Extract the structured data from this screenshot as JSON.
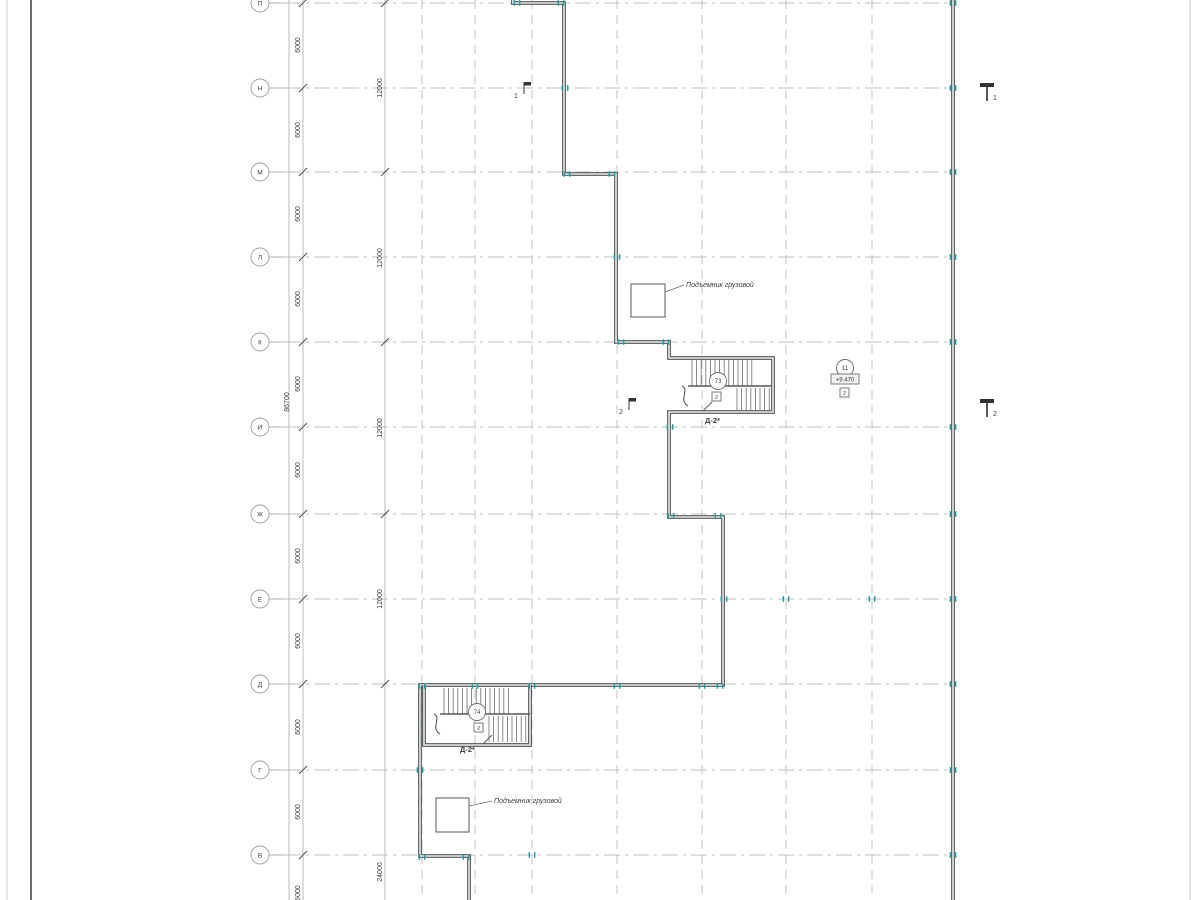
{
  "drawing": {
    "type": "architectural-floor-plan",
    "rows": [
      {
        "label": "П",
        "y": 3
      },
      {
        "label": "Н",
        "y": 88
      },
      {
        "label": "М",
        "y": 172
      },
      {
        "label": "Л",
        "y": 257
      },
      {
        "label": "К",
        "y": 342
      },
      {
        "label": "И",
        "y": 427
      },
      {
        "label": "Ж",
        "y": 514
      },
      {
        "label": "Е",
        "y": 599
      },
      {
        "label": "Д",
        "y": 684
      },
      {
        "label": "Г",
        "y": 770
      },
      {
        "label": "В",
        "y": 855
      }
    ],
    "cols_x": [
      422,
      475,
      532,
      617,
      702,
      786,
      872
    ],
    "right_wall_x": 953,
    "dims": {
      "overall": {
        "value": "86700",
        "x": 289,
        "text_y": 402
      },
      "d6000": {
        "value": "6000",
        "line_x": 303,
        "text_x": 300,
        "ys": [
          45,
          130,
          214,
          299,
          384,
          470,
          556,
          641,
          727,
          812,
          893
        ]
      },
      "d12000": {
        "line_x": 385,
        "text_x": 382,
        "tick_rows": [
          "П",
          "М",
          "К",
          "Ж",
          "Д"
        ],
        "labels": [
          {
            "value": "12000",
            "y": 88
          },
          {
            "value": "12000",
            "y": 258
          },
          {
            "value": "12000",
            "y": 428
          },
          {
            "value": "12000",
            "y": 599
          },
          {
            "value": "24000",
            "y": 872
          }
        ]
      }
    },
    "walls": {
      "outline": "M513,0 L513,3 L564,3 L564,174 L616,174 L616,342 L669,342 L669,358 L773,358 L773,412 L669,412 L669,517 L723,517 L723,685 L420,685 L420,856 L469,856 L469,900",
      "right": "M953,0 L953,900",
      "stair2_box": "M424,685 L424,745 L530,745 L530,685"
    },
    "stairs": [
      {
        "name": "stair-1",
        "circle": "73",
        "square": "2",
        "door_label": "Д-2*",
        "box": [
          669,
          358,
          104,
          54
        ],
        "flight1": [
          692,
          360,
          64,
          26
        ],
        "flight2": [
          737,
          388,
          35,
          22
        ],
        "divider_y": 386,
        "circle_cx": 718,
        "circle_cy": 381,
        "square_x": 712,
        "square_y": 392,
        "label_x": 705,
        "label_y": 423,
        "door_line": [
          703,
          411,
          712,
          402
        ]
      },
      {
        "name": "stair-2",
        "circle": "74",
        "square": "2",
        "door_label": "Д-2*",
        "box": [
          424,
          686,
          106,
          59
        ],
        "flight1": [
          444,
          688,
          66,
          26
        ],
        "flight2": [
          489,
          716,
          41,
          26
        ],
        "divider_y": 714,
        "circle_cx": 477,
        "circle_cy": 712,
        "square_x": 474,
        "square_y": 723,
        "label_x": 460,
        "label_y": 752,
        "door_line": [
          483,
          744,
          492,
          735
        ]
      }
    ],
    "lifts": [
      {
        "label": "Подъемник грузовой",
        "rect": [
          631,
          284,
          34,
          33
        ],
        "leader": [
          665,
          292,
          684,
          285
        ],
        "lx": 686,
        "ly": 287
      },
      {
        "label": "Подъемник грузовой",
        "rect": [
          436,
          798,
          33,
          34
        ],
        "leader": [
          469,
          806,
          492,
          801
        ],
        "lx": 494,
        "ly": 803
      }
    ],
    "section_marks": [
      {
        "n": "1",
        "x": 524,
        "y": 88,
        "side": "left"
      },
      {
        "n": "1",
        "x": 987,
        "y": 88,
        "side": "right"
      },
      {
        "n": "2",
        "x": 629,
        "y": 404,
        "side": "left"
      },
      {
        "n": "2",
        "x": 987,
        "y": 404,
        "side": "right"
      }
    ],
    "level_mark": {
      "circle": "11",
      "level": "+9.470",
      "square": "2",
      "cx": 845,
      "cy": 368,
      "box": [
        831,
        374,
        28,
        10
      ],
      "sq": [
        840,
        388,
        9,
        9
      ]
    },
    "ticks": [
      [
        953,
        3
      ],
      [
        953,
        88
      ],
      [
        953,
        172
      ],
      [
        953,
        257
      ],
      [
        953,
        342
      ],
      [
        953,
        427
      ],
      [
        953,
        514
      ],
      [
        953,
        599
      ],
      [
        953,
        684
      ],
      [
        953,
        770
      ],
      [
        953,
        855
      ],
      [
        517,
        3
      ],
      [
        561,
        3
      ],
      [
        565,
        88
      ],
      [
        567,
        174
      ],
      [
        612,
        174
      ],
      [
        617,
        257
      ],
      [
        621,
        342
      ],
      [
        666,
        342
      ],
      [
        670,
        427
      ],
      [
        671,
        516
      ],
      [
        718,
        516
      ],
      [
        724,
        599
      ],
      [
        786,
        599
      ],
      [
        872,
        599
      ],
      [
        422,
        686
      ],
      [
        475,
        686
      ],
      [
        532,
        686
      ],
      [
        617,
        686
      ],
      [
        702,
        686
      ],
      [
        720,
        686
      ],
      [
        420,
        770
      ],
      [
        422,
        857
      ],
      [
        466,
        857
      ],
      [
        532,
        855
      ]
    ],
    "colors": {
      "wall": "#54585a",
      "wall_inner": "#ebebeb",
      "grid": "#b9c0c0",
      "tick": "#2a9a9e",
      "text": "#3a3d3e",
      "bubble": "#9aa0a0",
      "dimline": "#a6acac",
      "frame_dark": "#4a4a4a",
      "frame_light": "#c9c9c9"
    }
  }
}
